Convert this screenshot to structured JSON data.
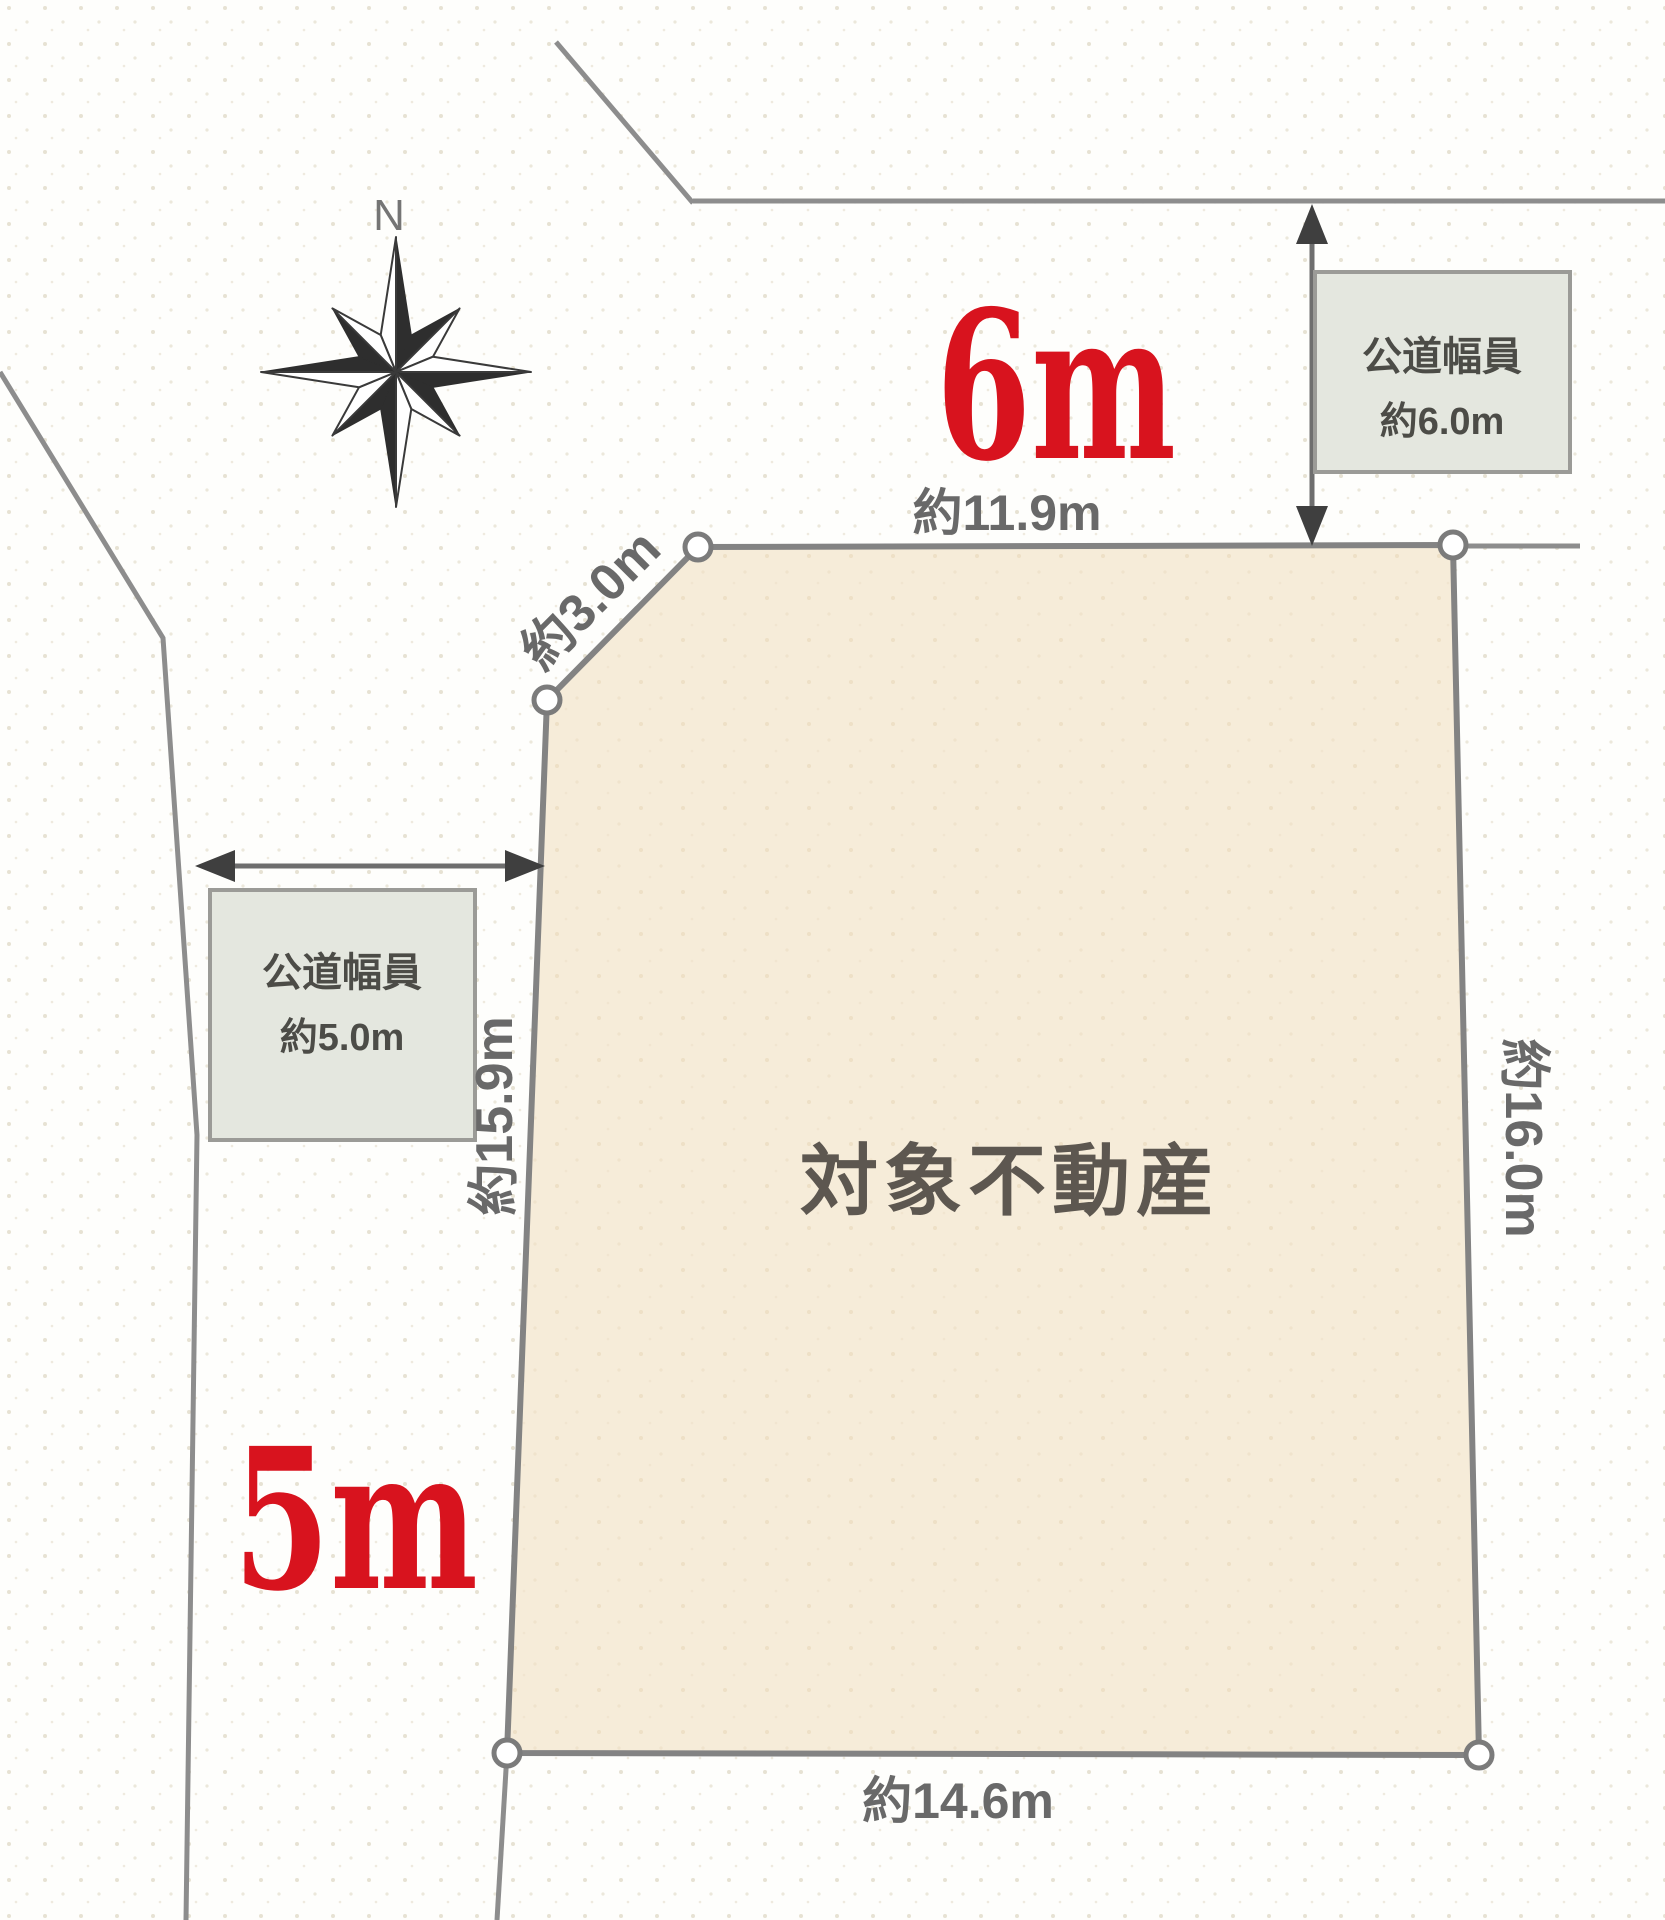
{
  "compass": {
    "north": "N"
  },
  "parcel": {
    "label": "対象不動産"
  },
  "dims": {
    "north": "約11.9m",
    "corner": "約3.0m",
    "west": "約15.9m",
    "east": "約16.0m",
    "south": "約14.6m"
  },
  "north_road": {
    "highlight": "6m",
    "box_title": "公道幅員",
    "box_value": "約6.0m"
  },
  "west_road": {
    "highlight": "5m",
    "box_title": "公道幅員",
    "box_value": "約5.0m"
  },
  "colors": {
    "highlight_red": "#d8131e",
    "parcel_fill": "#f6ecd9",
    "box_fill": "#e4e7df",
    "line_gray": "#8d8d8d",
    "dim_text_gray": "#696969",
    "parcel_label_gray": "#5d5750"
  }
}
